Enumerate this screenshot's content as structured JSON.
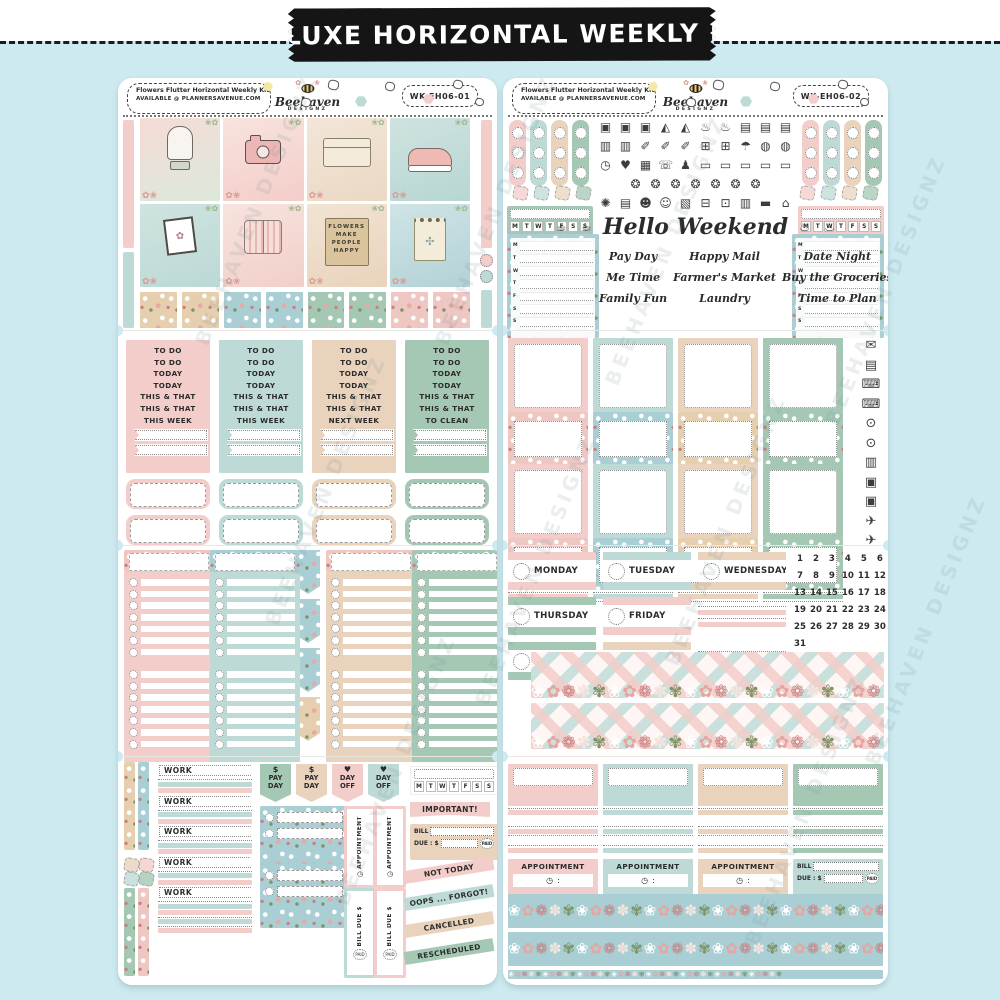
{
  "banner": {
    "title": "DELUXE HORIZONTAL WEEKLY KIT"
  },
  "brand": {
    "script": "Beehaven",
    "caps": "DESIGNZ"
  },
  "header": {
    "kit_name": "Flowers Flutter Horizontal Weekly Kit",
    "availability": "AVAILABLE @ PLANNERSAVENUE.COM",
    "codes": [
      "WK-EH06-01",
      "WK-EH06-02"
    ]
  },
  "watermark": "BEEHAVEN DESIGNZ",
  "colors": {
    "background": "#cdeaf0",
    "banner": "#151515",
    "pink": "#f2cdc9",
    "teal": "#bddad6",
    "tan": "#e9d3bc",
    "green": "#a5c8b5",
    "blue_floral": "#a9cfd4",
    "yellow": "#f6e7a2",
    "ink": "#2b2b2b",
    "white": "#ffffff"
  },
  "left_sheet": {
    "photo_boxes": [
      "butterfly-cloche",
      "camera",
      "keepsake-box",
      "flower-sneakers",
      "botanical-frame",
      "plaid-shirt",
      "flower-sign-bag",
      "dragonfly-notepad"
    ],
    "sign_text": [
      "FLOWERS",
      "MAKE",
      "PEOPLE",
      "HAPPY"
    ],
    "todo_columns": [
      {
        "color": "pink",
        "labels": [
          "TO DO",
          "TO DO",
          "TODAY",
          "TODAY",
          "THIS & THAT",
          "THIS & THAT",
          "THIS WEEK"
        ]
      },
      {
        "color": "teal",
        "labels": [
          "TO DO",
          "TO DO",
          "TODAY",
          "TODAY",
          "THIS & THAT",
          "THIS & THAT",
          "THIS WEEK"
        ]
      },
      {
        "color": "tan",
        "labels": [
          "TO DO",
          "TO DO",
          "TODAY",
          "TODAY",
          "THIS & THAT",
          "THIS & THAT",
          "NEXT WEEK"
        ]
      },
      {
        "color": "green",
        "labels": [
          "TO DO",
          "TO DO",
          "TODAY",
          "TODAY",
          "THIS & THAT",
          "THIS & THAT",
          "TO CLEAN"
        ]
      }
    ],
    "checklist_colors": [
      "pink",
      "teal",
      "tan",
      "green"
    ],
    "work_flags": {
      "label": "WORK",
      "count": 5
    },
    "pennants": [
      {
        "icon": "$",
        "label": "PAY DAY",
        "color": "green"
      },
      {
        "icon": "$",
        "label": "PAY DAY",
        "color": "tan"
      },
      {
        "icon": "♥",
        "label": "DAY OFF",
        "color": "pink"
      },
      {
        "icon": "♥",
        "label": "DAY OFF",
        "color": "teal"
      }
    ],
    "appointment_label": "APPOINTMENT",
    "bill_vertical": {
      "text": "BILL DUE $",
      "paid": "PAID",
      "colors": [
        "teal",
        "pink"
      ]
    },
    "habit_tracker_letters": [
      "M",
      "T",
      "W",
      "T",
      "F",
      "S",
      "S"
    ],
    "important_label": "IMPORTANT!",
    "bill_box": {
      "bill": "BILL",
      "due": "DUE :",
      "currency": "$",
      "paid": "PAID"
    },
    "diagonal_labels": [
      {
        "text": "NOT TODAY",
        "color": "pink"
      },
      {
        "text": "OOPS ... FORGOT!",
        "color": "teal"
      },
      {
        "text": "CANCELLED",
        "color": "tan"
      },
      {
        "text": "RESCHEDULED",
        "color": "green"
      }
    ]
  },
  "right_sheet": {
    "scallop_colors": [
      "pink",
      "teal",
      "tan",
      "green"
    ],
    "icon_rows": [
      [
        "washing-machine",
        "washing-machine",
        "washing-machine",
        "iron",
        "iron",
        "mixer",
        "mixer",
        "laundry-basket",
        "laundry-basket",
        "laundry-basket"
      ],
      [
        "trash-can",
        "trash-can",
        "spray-bottle",
        "spray-bottle",
        "spray-bottle",
        "shopping-cart",
        "shopping-cart",
        "umbrella",
        "globe",
        "globe"
      ],
      [
        "clock",
        "heart",
        "cake",
        "phone",
        "bowling-pins",
        "tv",
        "tv",
        "tv",
        "tv",
        "tv"
      ],
      [
        "meal",
        "meal",
        "meal",
        "meal",
        "meal",
        "meal",
        "meal"
      ],
      [
        "bee",
        "calendar",
        "dog",
        "cat",
        "gift",
        "car",
        "fuel-pump",
        "notebook",
        "money",
        "house"
      ]
    ],
    "hello_icons_left": [
      "coffee-cup",
      "coffee-cup"
    ],
    "hello_icons_right": [
      "kettle",
      "kettle"
    ],
    "hello_weekend": "Hello Weekend",
    "script_phrases": [
      "Pay Day",
      "Happy Mail",
      "Date Night",
      "Me Time",
      "Farmer's Market",
      "Buy the Groceries",
      "Family Fun",
      "Laundry",
      "Time to Plan"
    ],
    "box_colors": [
      "pink",
      "teal",
      "tan",
      "green"
    ],
    "side_icons": [
      "envelope",
      "tickets",
      "laptop",
      "laptop",
      "money-bag",
      "money-bag",
      "receipt",
      "camera",
      "camera",
      "plane",
      "plane"
    ],
    "day_stickers": [
      {
        "name": "MONDAY",
        "color": "pink"
      },
      {
        "name": "TUESDAY",
        "color": "teal"
      },
      {
        "name": "WEDNESDAY",
        "color": "tan"
      },
      {
        "name": "THURSDAY",
        "color": "green"
      },
      {
        "name": "FRIDAY",
        "color": "pink"
      },
      {
        "name": "SATURDAY",
        "color": "green"
      },
      {
        "name": "SUNDAY",
        "color": "tan"
      }
    ],
    "dates": [
      "1",
      "2",
      "3",
      "4",
      "5",
      "6",
      "7",
      "8",
      "9",
      "10",
      "11",
      "12",
      "13",
      "14",
      "15",
      "16",
      "17",
      "18",
      "19",
      "20",
      "21",
      "22",
      "23",
      "24",
      "25",
      "26",
      "27",
      "28",
      "29",
      "30",
      "31"
    ],
    "appointment_label": "APPOINTMENT",
    "bill_box": {
      "bill": "BILL",
      "due": "DUE :",
      "currency": "$",
      "paid": "PAID"
    },
    "habit_tracker_letters": [
      "M",
      "T",
      "W",
      "T",
      "F",
      "S",
      "S"
    ]
  },
  "icon_glyphs": {
    "washing-machine": "▣",
    "iron": "◭",
    "mixer": "♨",
    "laundry-basket": "▤",
    "trash-can": "▥",
    "spray-bottle": "✐",
    "shopping-cart": "⊞",
    "umbrella": "☂",
    "globe": "◍",
    "clock": "◷",
    "heart": "♥",
    "cake": "▦",
    "phone": "☏",
    "bowling-pins": "♟",
    "tv": "▭",
    "meal": "❂",
    "bee": "✺",
    "calendar": "▤",
    "dog": "☻",
    "cat": "☺",
    "gift": "▧",
    "car": "⊟",
    "fuel-pump": "⊡",
    "notebook": "▥",
    "money": "▬",
    "house": "⌂",
    "coffee-cup": "☕",
    "kettle": "♨",
    "envelope": "✉",
    "tickets": "▤",
    "laptop": "⌨",
    "money-bag": "⊙",
    "receipt": "▥",
    "camera": "▣",
    "plane": "✈"
  }
}
